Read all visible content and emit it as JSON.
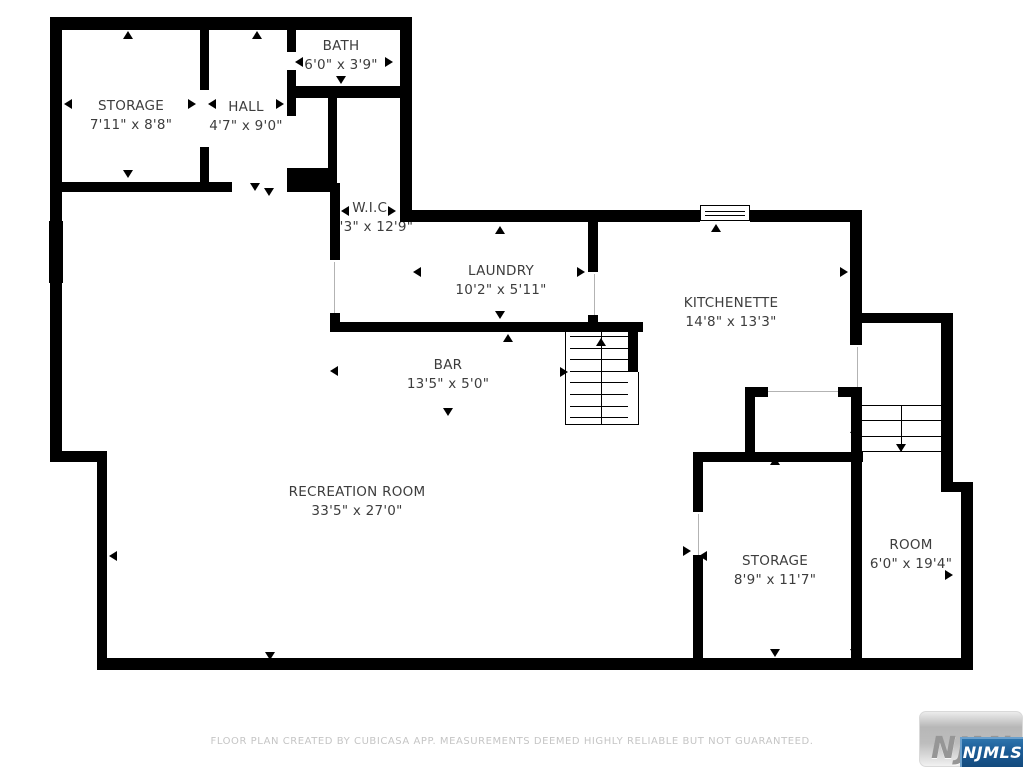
{
  "rooms": [
    {
      "name": "STORAGE",
      "dims": "7'11\" x 8'8\""
    },
    {
      "name": "HALL",
      "dims": "4'7\" x 9'0\""
    },
    {
      "name": "BATH",
      "dims": "6'0\" x 3'9\""
    },
    {
      "name": "W.I.C.",
      "dims": "4'3\" x 12'9\""
    },
    {
      "name": "LAUNDRY",
      "dims": "10'2\" x 5'11\""
    },
    {
      "name": "KITCHENETTE",
      "dims": "14'8\" x 13'3\""
    },
    {
      "name": "BAR",
      "dims": "13'5\" x 5'0\""
    },
    {
      "name": "RECREATION ROOM",
      "dims": "33'5\" x 27'0\""
    },
    {
      "name": "STORAGE",
      "dims": "8'9\" x 11'7\""
    },
    {
      "name": "ROOM",
      "dims": "6'0\" x 19'4\""
    }
  ],
  "footer": "FLOOR PLAN CREATED BY CUBICASA APP. MEASUREMENTS DEEMED HIGHLY RELIABLE BUT NOT GUARANTEED.",
  "logo": {
    "button_text": "NJMLS",
    "badge_text": "NJMLS"
  },
  "colors": {
    "wall": "#000000",
    "background": "#ffffff",
    "label_text": "#3d3d3d",
    "footer_text": "#c5c5c5",
    "badge_blue": "#1b5b95",
    "button_gray": "#bdbdbd"
  }
}
